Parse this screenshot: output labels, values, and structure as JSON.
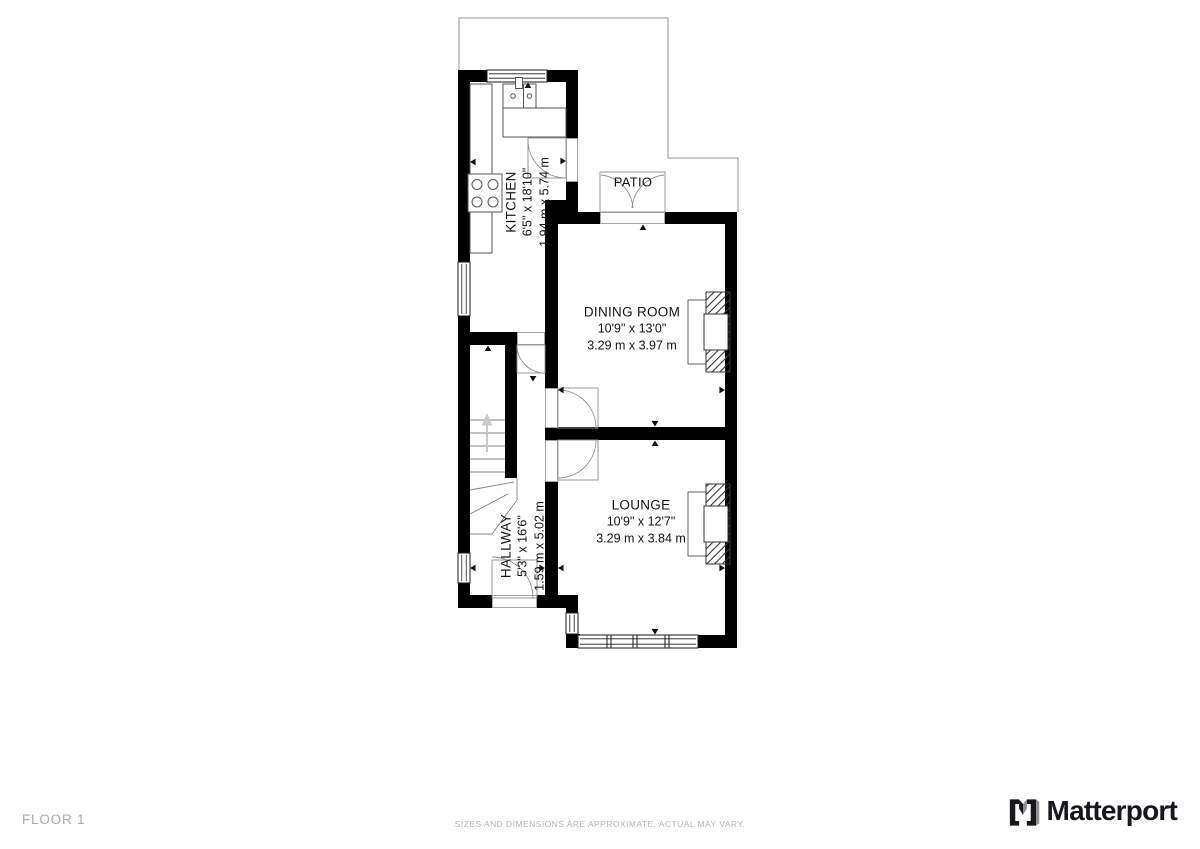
{
  "floor": {
    "label": "FLOOR 1"
  },
  "footer": {
    "disclaimer": "SIZES AND DIMENSIONS ARE APPROXIMATE, ACTUAL MAY VARY."
  },
  "brand": {
    "wordmark": "Matterport"
  },
  "plan": {
    "rooms": [
      {
        "name": "KITCHEN",
        "size_imperial": "6'5\" x 18'10\"",
        "size_metric": "1.94 m x 5.74 m"
      },
      {
        "name": "DINING ROOM",
        "size_imperial": "10'9\" x 13'0\"",
        "size_metric": "3.29 m x 3.97 m"
      },
      {
        "name": "HALLWAY",
        "size_imperial": "5'3\" x 16'6\"",
        "size_metric": "1.59 m x 5.02 m"
      },
      {
        "name": "LOUNGE",
        "size_imperial": "10'9\" x 12'7\"",
        "size_metric": "3.29 m x 3.84 m"
      },
      {
        "name": "PATIO",
        "size_imperial": "",
        "size_metric": ""
      }
    ],
    "colors": {
      "wall": "#000000",
      "property_outline": "#9a9a9a",
      "fixture_stroke": "#555555",
      "door_stroke": "#8f8f8f",
      "stair_arrow": "#c8c8c8",
      "footer_text": "#a9a9a9",
      "brand_dark": "#17171f",
      "brand_gray": "#8d8d92"
    }
  }
}
